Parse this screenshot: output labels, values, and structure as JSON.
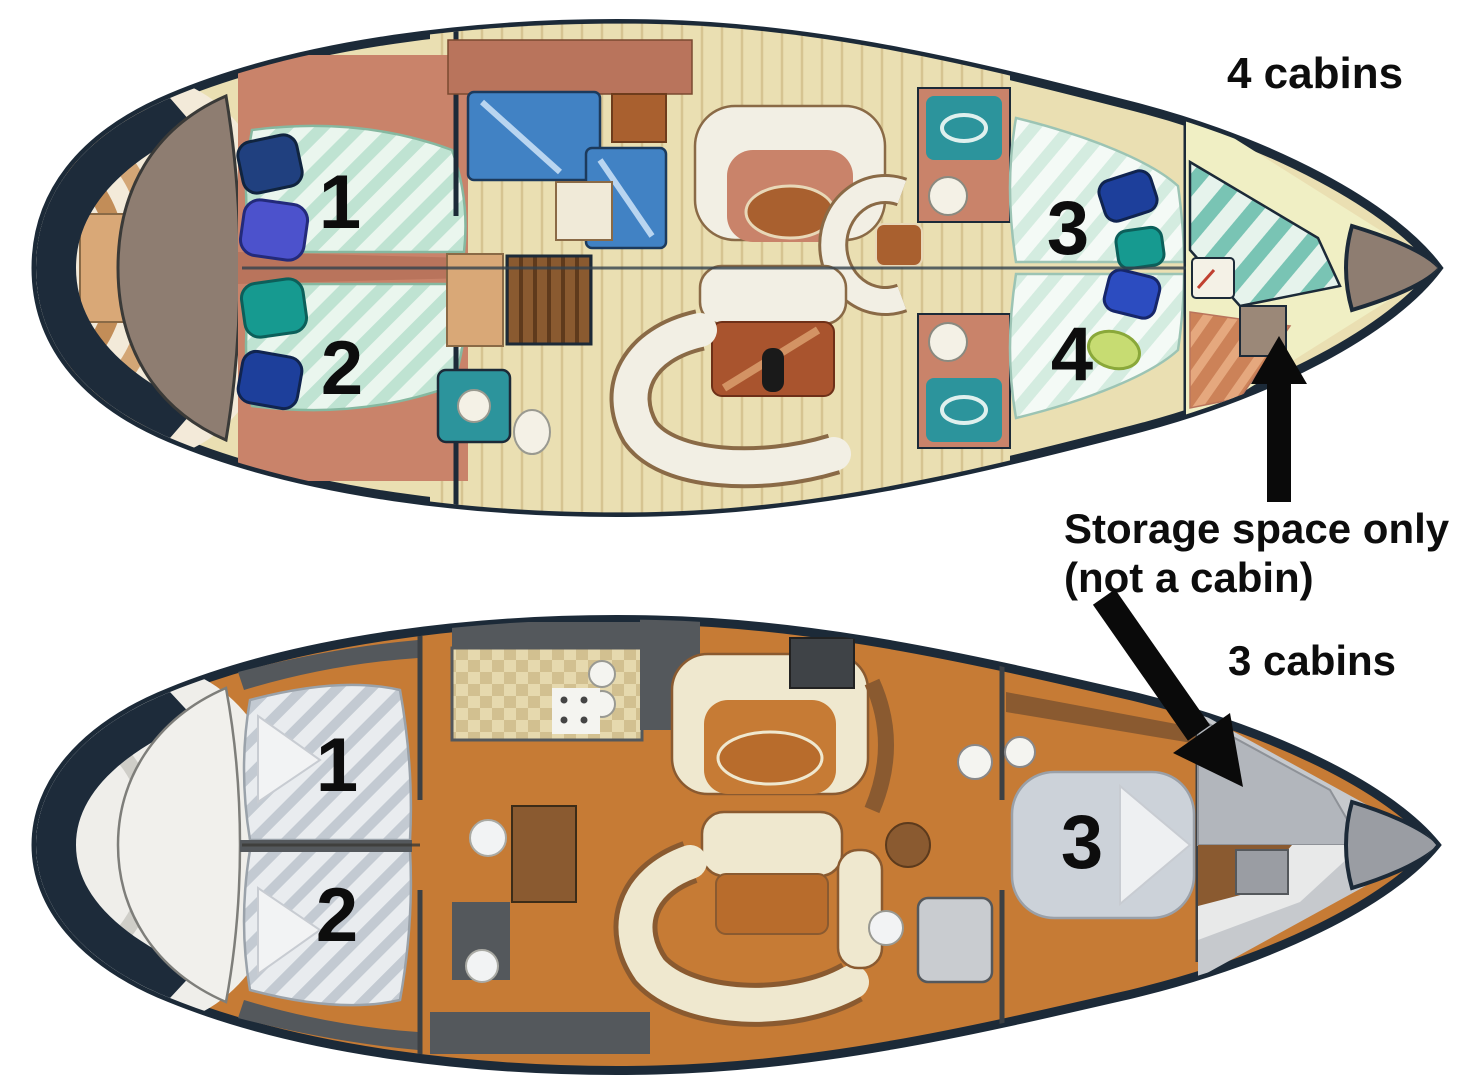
{
  "figure": {
    "description": "Sailing yacht interior floor plans compared",
    "annotations": {
      "four_cabins_label": "4 cabins",
      "three_cabins_label": "3 cabins",
      "storage_note_line1": "Storage space only",
      "storage_note_line2": "(not a cabin)"
    },
    "top_boat": {
      "label": "4 cabins",
      "cabin_numbers": [
        "1",
        "2",
        "3",
        "4"
      ]
    },
    "bottom_boat": {
      "label": "3 cabins",
      "cabin_numbers": [
        "1",
        "2",
        "3"
      ]
    },
    "colors": {
      "hull_outline": "#1c2a38",
      "annotation_text": "#0d0d0d",
      "arrow": "#0a0a0a",
      "top_floor_wood": "#eadfb2",
      "top_bed_mint": "#cdeedd",
      "top_counter_blue": "#4182c4",
      "top_sofa_white": "#f2efe4",
      "top_furniture_salmon": "#c9836a",
      "cockpit_taupe": "#8e7d71",
      "bottom_floor_orange": "#c67b35",
      "bottom_bed_gray": "#ccd2d9",
      "bottom_sofa_cream": "#efe8cf",
      "bottom_wall_slate": "#54585c",
      "storage_teal_stripe": "#79c4b4",
      "bow_storage_gray": "#b2b6bc"
    }
  }
}
